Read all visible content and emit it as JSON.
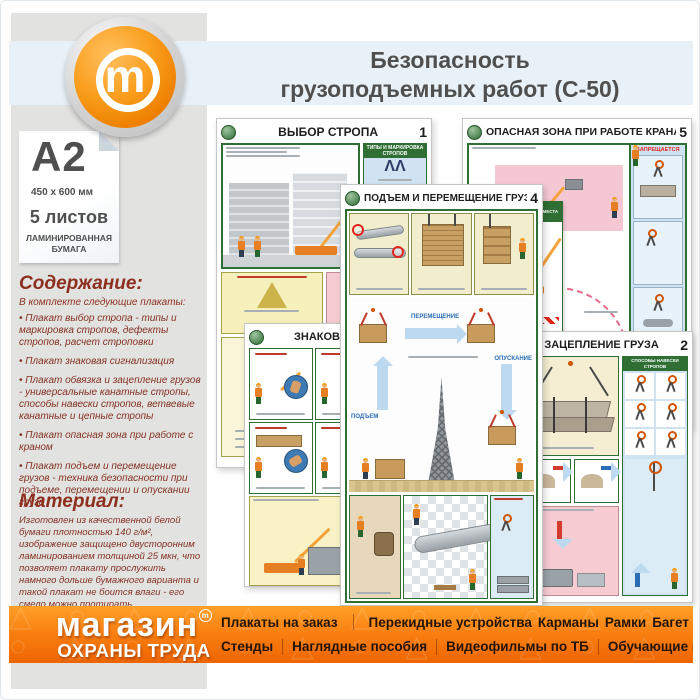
{
  "page": {
    "title_line1": "Безопасность",
    "title_line2": "грузоподъемных работ (С-50)",
    "logo_letter": "m"
  },
  "sidebar": {
    "format_label": "A2",
    "format_size": "450 x 600 мм",
    "sheets_label": "5 листов",
    "paper_label": "ЛАМИНИРОВАННАЯ БУМАГА",
    "content": {
      "heading": "Содержание:",
      "intro": "В комплекте следующие плакаты:",
      "items": [
        "Плакат выбор стропа - типы и маркировка стропов, дефекты стропов, расчет строповки",
        "Плакат знаковая сигнализация",
        "Плакат обвязка и зацепление грузов - универсальные канатные стропы, способы навески стропов, ветвевые канатные и цепные стропы",
        "Плакат опасная зона при работе с краном",
        "Плакат подъем и перемещение грузов - техника безопасности при подъеме, перемещении и опускании груза"
      ]
    },
    "material": {
      "heading": "Материал:",
      "text": "Изготовлен из качественной белой бумаги плотностью 140 г/м², изображение защищено двусторонним ламинированием толщиной 25 мкн, что позволяет плакату прослужить намного дольше бумажного варианта и такой плакат не боится влаги - его смело можно протирать."
    }
  },
  "posters": {
    "vybor": {
      "title": "ВЫБОР СТРОПА",
      "number": "1",
      "types_panel": "ТИПЫ И МАРКИРОВКА СТРОПОВ",
      "tag_panel": "МАРКИРОВОЧНАЯ БИРКА СТРОПА"
    },
    "opasnaya": {
      "title": "ОПАСНАЯ ЗОНА ПРИ РАБОТЕ КРАНА",
      "number": "5",
      "forbidden_label": "ЗАПРЕЩАЕТСЯ",
      "fence_label": "СЛЕДИ ЗА ОГРАЖДЕНИЕМ МЕСТА РАБОТ"
    },
    "podyem": {
      "title": "ПОДЪЕМ И ПЕРЕМЕЩЕНИЕ ГРУЗА",
      "number": "4",
      "lift_label": "ПОДЪЕМ",
      "move_label": "ПЕРЕМЕЩЕНИЕ",
      "lower_label": "ОПУСКАНИЕ"
    },
    "znakovaya": {
      "title": "ЗНАКОВАЯ СИГНАЛИЗАЦИЯ"
    },
    "zaceplenie": {
      "title": "ЗАЦЕПЛЕНИЕ ГРУЗА",
      "number": "2",
      "hanging_panel": "СПОСОБЫ НАВЕСКИ СТРОПОВ"
    }
  },
  "footer": {
    "brand_line1": "магазин",
    "brand_line2": "ОХРАНЫ ТРУДА",
    "brand_mark": "m",
    "menu_row1": [
      "Плакаты на заказ",
      "Перекидные устройства",
      "Карманы",
      "Рамки",
      "Багет"
    ],
    "menu_row2": [
      "Стенды",
      "Наглядные пособия",
      "Видеофильмы по ТБ",
      "Обучающие программы"
    ]
  },
  "colors": {
    "accent_orange": "#f28c00",
    "footer_orange_top": "#ffa028",
    "footer_orange_bottom": "#ee6502",
    "band_blue": "#e8f1f7",
    "sidebar_gray": "#e2e2e0",
    "heading_maroon": "#8d2f1f",
    "poster_green": "#2f6f33",
    "title_gray": "#4f4f4f"
  }
}
